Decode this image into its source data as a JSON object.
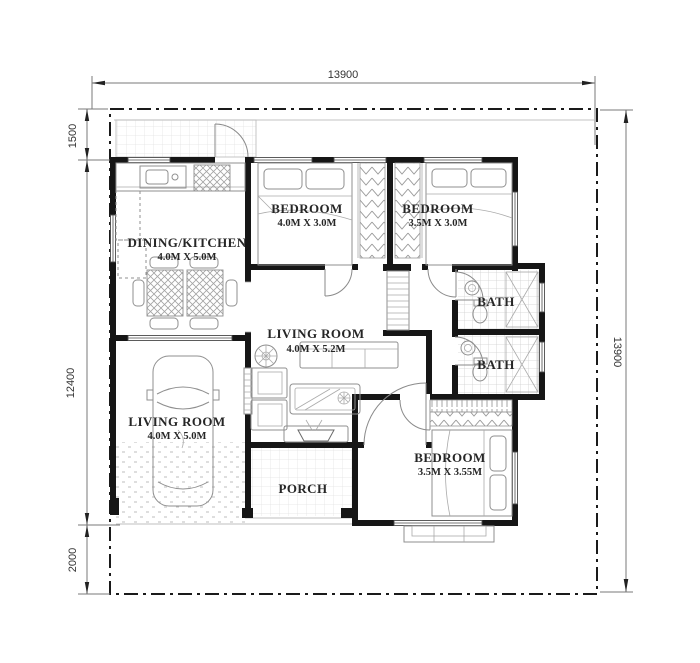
{
  "plan": {
    "dimensions": {
      "top_width": "13900",
      "right_height": "13900",
      "left_upper": "1500",
      "left_middle": "12400",
      "left_lower": "2000"
    },
    "rooms": {
      "dining_kitchen": {
        "label": "DINING/KITCHEN",
        "size": "4.0M X 5.0M"
      },
      "bedroom_1": {
        "label": "BEDROOM",
        "size": "4.0M X 3.0M"
      },
      "bedroom_2": {
        "label": "BEDROOM",
        "size": "3.5M X 3.0M"
      },
      "bedroom_3": {
        "label": "BEDROOM",
        "size": "3.5M X 3.55M"
      },
      "living_room": {
        "label": "LIVING ROOM",
        "size": "4.0M X 5.2M"
      },
      "garage_living_room": {
        "label": "LIVING ROOM",
        "size": "4.0M X 5.0M"
      },
      "bath_upper": {
        "label": "BATH"
      },
      "bath_lower": {
        "label": "BATH"
      },
      "porch": {
        "label": "PORCH"
      }
    },
    "colors": {
      "wall": "#161616",
      "boundary": "#1a1a1a",
      "dimension_line": "#7a7a7a",
      "furniture_line": "#8f8f8f",
      "tile_line": "#dedede",
      "label_text": "#262626",
      "dim_text": "#333333"
    }
  }
}
